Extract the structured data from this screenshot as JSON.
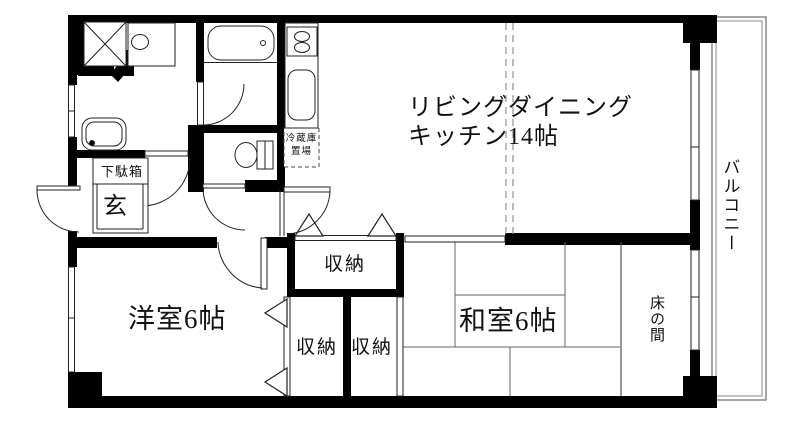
{
  "labels": {
    "ldk_line1": "リビングダイニング",
    "ldk_line2": "キッチン14帖",
    "western_room": "洋室6帖",
    "japanese_room": "和室6帖",
    "balcony": "バルコニー",
    "tokonoma": "床の間",
    "genkan": "玄",
    "shoe_cabinet": "下駄箱",
    "storage_top": "収納",
    "storage_bottom_left": "収納",
    "storage_bottom_right": "収納",
    "fridge_space_line1": "冷蔵庫",
    "fridge_space_line2": "置場"
  },
  "colors": {
    "wall": "#000000",
    "thin_line": "#222222",
    "tatami_line": "#666666",
    "dashed_line": "#999999",
    "balcony_line": "#888888",
    "background": "#ffffff",
    "text": "#111111"
  }
}
